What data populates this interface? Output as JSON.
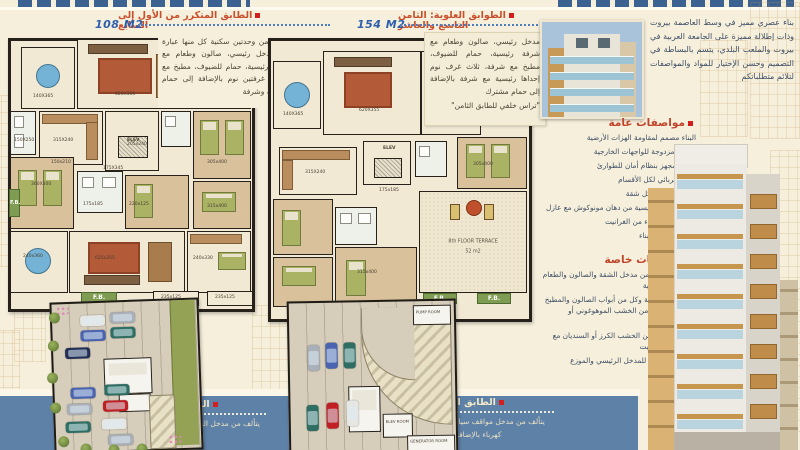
{
  "colors": {
    "background": "#f6efdb",
    "band_blue": "#5e81a7",
    "heading_red": "#c9502d",
    "area_blue": "#2d5fae",
    "bullet_red": "#d21e1e",
    "body_text": "#3d4e66"
  },
  "floors": {
    "repeated": {
      "title": "الطابق المتكرر من الأول إلى السابع",
      "area": "108 M2",
      "description": "مؤلف من وحدتين سكنية كل منها عبارة عن مدخل رئيسي، صالون وطعام مع شرفة رئيسية، حمام للضيوف، مطبخ مع شرفة، غرفتين نوم بالإضافة إلى حمام مشترك وشرفة"
    },
    "upper": {
      "title": "الطوابق العلوية: الثامن التاسع والعاشر",
      "area": "154 M2",
      "description": "مدخل رئيسي، صالون وطعام مع شرفة رئيسية، حمام للضيوف، مطبخ مع شرفة، ثلاث غرف نوم إحداها رئيسية مع شرفة بالإضافة إلى حمام مشترك",
      "note": "\"تراس خلفي للطابق الثامن\""
    },
    "ground": {
      "title": "الطابق الأرضي",
      "description": "يتألف من مدخل البناء ومواقف سيارات"
    },
    "basement": {
      "title": "الطابق السفلي",
      "description": "يتألف من مدخل مواقف سيارات وغرفة كهرباء بالإضافة إلى غرفة"
    }
  },
  "intro": "بناء عصري مميز في وسط العاصمة بيروت وذات إطلالة مميزة على الجامعة العربية في بيروت والملعب البلدي، يتسم بالبساطة في التصميم وحسن الإختيار للمواد والمواصفات لتلائم متطلباتكم",
  "general_specs": {
    "title": "مواصفات عامة",
    "items": [
      "البناء مصمم لمقاومة الهزات الأرضية",
      "حوائط مزدوجة للواجهات الخارجية",
      "مصعد مجهز بنظام أمان للطوارئ",
      "مواد كهربائي لكل الأقسام",
      "خزان مستقل لكل شقة",
      "واجهة البناء الرئيسية من دهان مونوكوش مع عازل",
      "مدخل ودرج البناء من الغرانيت",
      "نظام إنترفون للبناء"
    ]
  },
  "special_specs": {
    "title": "مواصفات خاصة",
    "items": [
      "بلاط رخام لكل من مدخل الشقة والصالون والطعام والشرفة الرئيسية",
      "باب مدخل الشقة وكل من أبواب الصالون والمطبخ وحمام الضيوف من الخشب الموهوغوني أو السنديان",
      "خزائن المطبخ من الخشب الكرز أو السنديان مع مجلى من الغرانيت",
      "أسقف مستعارة للمدخل الرئيسي والموزع والحمامات"
    ]
  },
  "plan_labels": {
    "left": [
      "140X365",
      "620X355",
      "315X240",
      "150X250",
      "205x240",
      "360X300",
      "175X345",
      "175x185",
      "220x125",
      "305x400",
      "315x400",
      "240x360",
      "625x355",
      "240x330",
      "235x125",
      "235x125",
      "150x210"
    ],
    "mid": [
      "140X365",
      "620X355",
      "315X240",
      "175x185",
      "305x400",
      "315x400",
      "235x125",
      "235x125"
    ],
    "elev": "ELEV",
    "fb": "F.B.",
    "terrace_line1": "8th FLOOR TERRACE",
    "terrace_line2": "52 m2"
  },
  "parking": {
    "pump_room": "PUMP ROOM",
    "elev_room": "ELEV ROOM",
    "generator_room": "GENERATOR ROOM",
    "car_colors": {
      "white": "#e6e6e2",
      "silver": "#aab0b8",
      "blue": "#4a64b0",
      "navy": "#232f55",
      "teal": "#2f6f63",
      "red": "#c01f24"
    }
  }
}
